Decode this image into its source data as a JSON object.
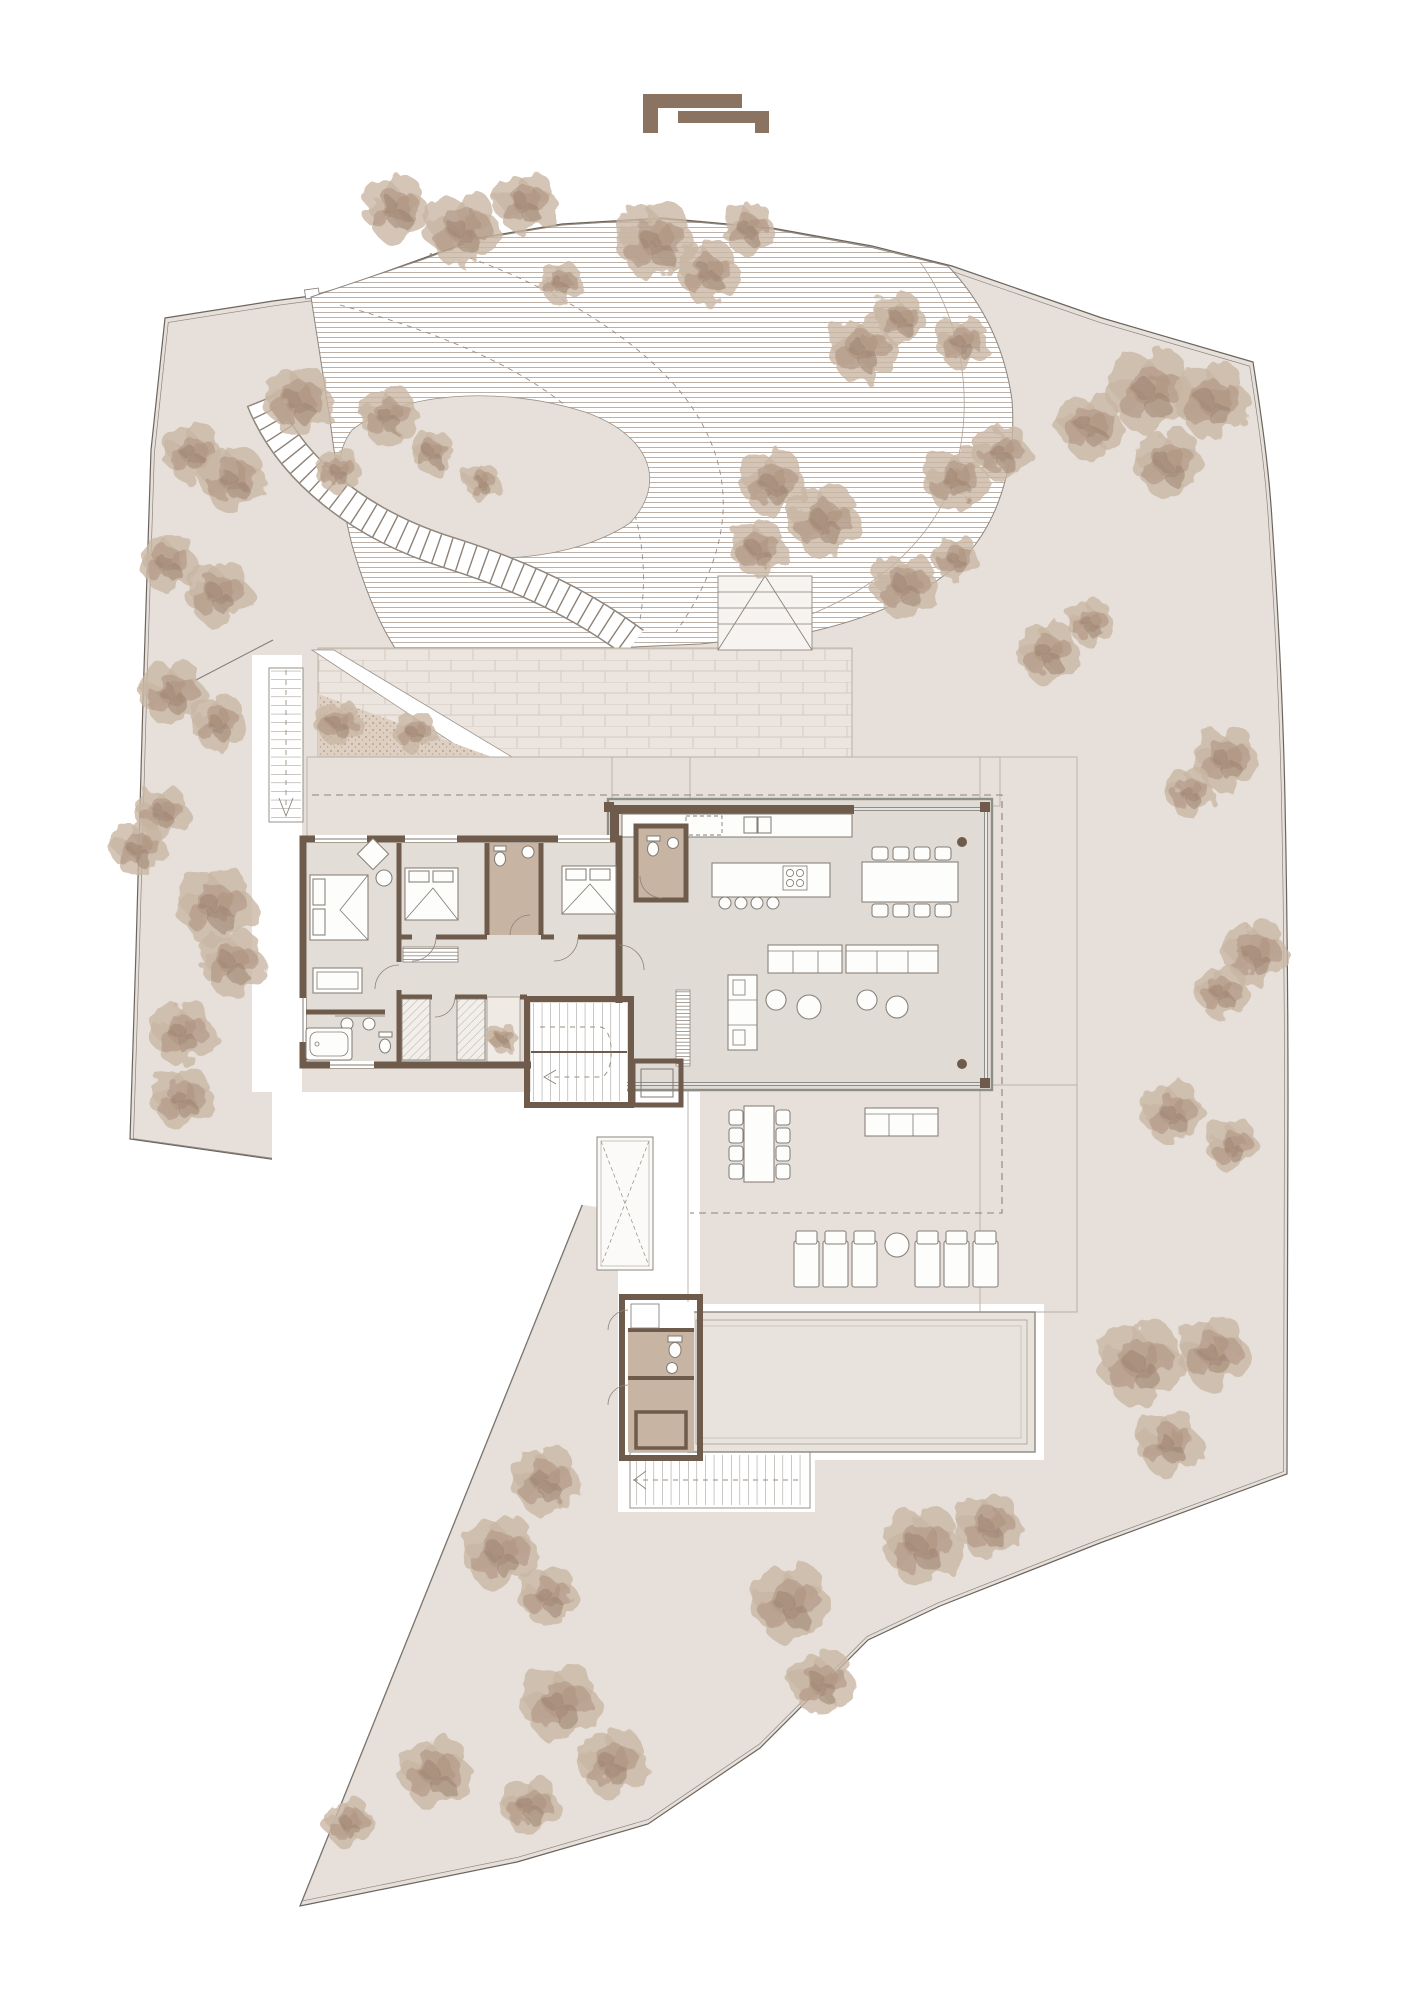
{
  "page": {
    "background": "#ffffff",
    "type": "architectural site plan, ground floor with garden"
  },
  "logo": {
    "color": "#8a7361",
    "name": "interlocking-bracket monogram"
  },
  "palette": {
    "site": "#e7e0da",
    "outside": "#ffffff",
    "boundary": "#6b655e",
    "terraceBrick": "#ece5df",
    "brickLine": "#d5c9bf",
    "deck": "#ece6e0",
    "deckLine": "#d9cfc6",
    "driveLine": "#ad9e91",
    "wall": "#6f5b4b",
    "wet": "#c7b4a3",
    "floor": "#e3ddd7",
    "pavilionFloor": "#e0dbd4",
    "pool": "#e9e3dd",
    "plantBed": "#ddcfc2",
    "tree1": "#c9b6a4",
    "tree2": "#b09682",
    "tree3": "#9c8270",
    "logo": "#8a7361"
  },
  "plan": {
    "elements": [
      "site-boundary",
      "curved-driveway",
      "stepped-garden-path",
      "garage-roof-terrace",
      "planted-triangle",
      "exterior-stair",
      "bedroom-wing",
      "living-pavilion",
      "kitchen-island",
      "indoor-dining-table",
      "sofa-group",
      "tv-unit",
      "outdoor-deck",
      "outdoor-dining-table",
      "outdoor-sofa",
      "sun-loungers",
      "swimming-pool",
      "pool-house",
      "pool-stair",
      "light-well",
      "interior-stair",
      "elevator",
      "courtyard-tree"
    ],
    "counts": {
      "bedrooms": 4,
      "indoor_dining_chairs": 8,
      "outdoor_dining_chairs": 8,
      "kitchen_stools": 4,
      "sun_loungers": 6,
      "sofa_poufs": 4
    }
  },
  "furniture": {
    "indoor_dining": {
      "table": [
        862,
        862,
        96,
        40
      ],
      "chair_xs": [
        872,
        893,
        914,
        935
      ],
      "chair_ys": [
        847,
        904
      ],
      "chair_w": 16,
      "chair_h": 13
    },
    "outdoor_dining": {
      "table": [
        744,
        1106,
        30,
        76
      ],
      "chair_cols": [
        729,
        776
      ],
      "chair_ys": [
        1110,
        1128,
        1146,
        1164
      ],
      "chair_w": 14,
      "chair_h": 15
    },
    "loungers": {
      "xs": [
        794,
        823,
        852,
        915,
        944,
        973
      ],
      "y": 1231,
      "w": 25,
      "h": 56
    },
    "lounger_table": {
      "cx": 897,
      "cy": 1245,
      "r": 12
    },
    "kitchen_stools": {
      "xs": [
        725,
        741,
        757,
        773
      ],
      "y": 903,
      "r": 6
    },
    "poufs": [
      [
        776,
        1000,
        10
      ],
      [
        809,
        1007,
        12
      ],
      [
        867,
        1000,
        10
      ],
      [
        897,
        1007,
        11
      ]
    ]
  },
  "trees": [
    [
      395,
      208,
      1.0
    ],
    [
      462,
      228,
      1.15
    ],
    [
      525,
      202,
      0.95
    ],
    [
      560,
      282,
      0.65
    ],
    [
      655,
      240,
      1.2
    ],
    [
      708,
      272,
      0.95
    ],
    [
      748,
      228,
      0.8
    ],
    [
      862,
      348,
      1.05
    ],
    [
      900,
      318,
      0.75
    ],
    [
      962,
      342,
      0.8
    ],
    [
      955,
      478,
      1.0
    ],
    [
      1002,
      452,
      0.85
    ],
    [
      772,
      482,
      1.0
    ],
    [
      824,
      520,
      1.1
    ],
    [
      758,
      548,
      0.85
    ],
    [
      905,
      585,
      1.0
    ],
    [
      956,
      558,
      0.7
    ],
    [
      1048,
      652,
      0.95
    ],
    [
      1090,
      622,
      0.7
    ],
    [
      1090,
      425,
      1.0
    ],
    [
      1150,
      390,
      1.3
    ],
    [
      1212,
      400,
      1.15
    ],
    [
      1168,
      462,
      1.05
    ],
    [
      298,
      400,
      1.05
    ],
    [
      388,
      415,
      0.9
    ],
    [
      192,
      452,
      0.9
    ],
    [
      232,
      478,
      1.0
    ],
    [
      338,
      470,
      0.7
    ],
    [
      432,
      452,
      0.65
    ],
    [
      482,
      482,
      0.55
    ],
    [
      168,
      562,
      0.9
    ],
    [
      218,
      592,
      1.0
    ],
    [
      172,
      692,
      1.0
    ],
    [
      218,
      722,
      0.85
    ],
    [
      162,
      812,
      0.8
    ],
    [
      138,
      848,
      0.85
    ],
    [
      215,
      905,
      1.2
    ],
    [
      232,
      962,
      1.0
    ],
    [
      182,
      1032,
      1.0
    ],
    [
      182,
      1098,
      0.95
    ],
    [
      1225,
      758,
      1.0
    ],
    [
      1190,
      792,
      0.75
    ],
    [
      1255,
      952,
      1.0
    ],
    [
      1222,
      992,
      0.8
    ],
    [
      1172,
      1112,
      0.95
    ],
    [
      1232,
      1145,
      0.8
    ],
    [
      338,
      722,
      0.7
    ],
    [
      415,
      732,
      0.65
    ],
    [
      503,
      1038,
      0.45
    ],
    [
      1140,
      1362,
      1.3
    ],
    [
      1213,
      1352,
      1.1
    ],
    [
      1168,
      1442,
      1.0
    ],
    [
      922,
      1545,
      1.2
    ],
    [
      988,
      1525,
      1.0
    ],
    [
      545,
      1480,
      1.05
    ],
    [
      500,
      1552,
      1.15
    ],
    [
      548,
      1595,
      0.9
    ],
    [
      560,
      1702,
      1.2
    ],
    [
      612,
      1762,
      1.05
    ],
    [
      530,
      1805,
      0.9
    ],
    [
      435,
      1772,
      1.1
    ],
    [
      348,
      1822,
      0.75
    ],
    [
      790,
      1602,
      1.2
    ],
    [
      822,
      1682,
      1.0
    ]
  ]
}
